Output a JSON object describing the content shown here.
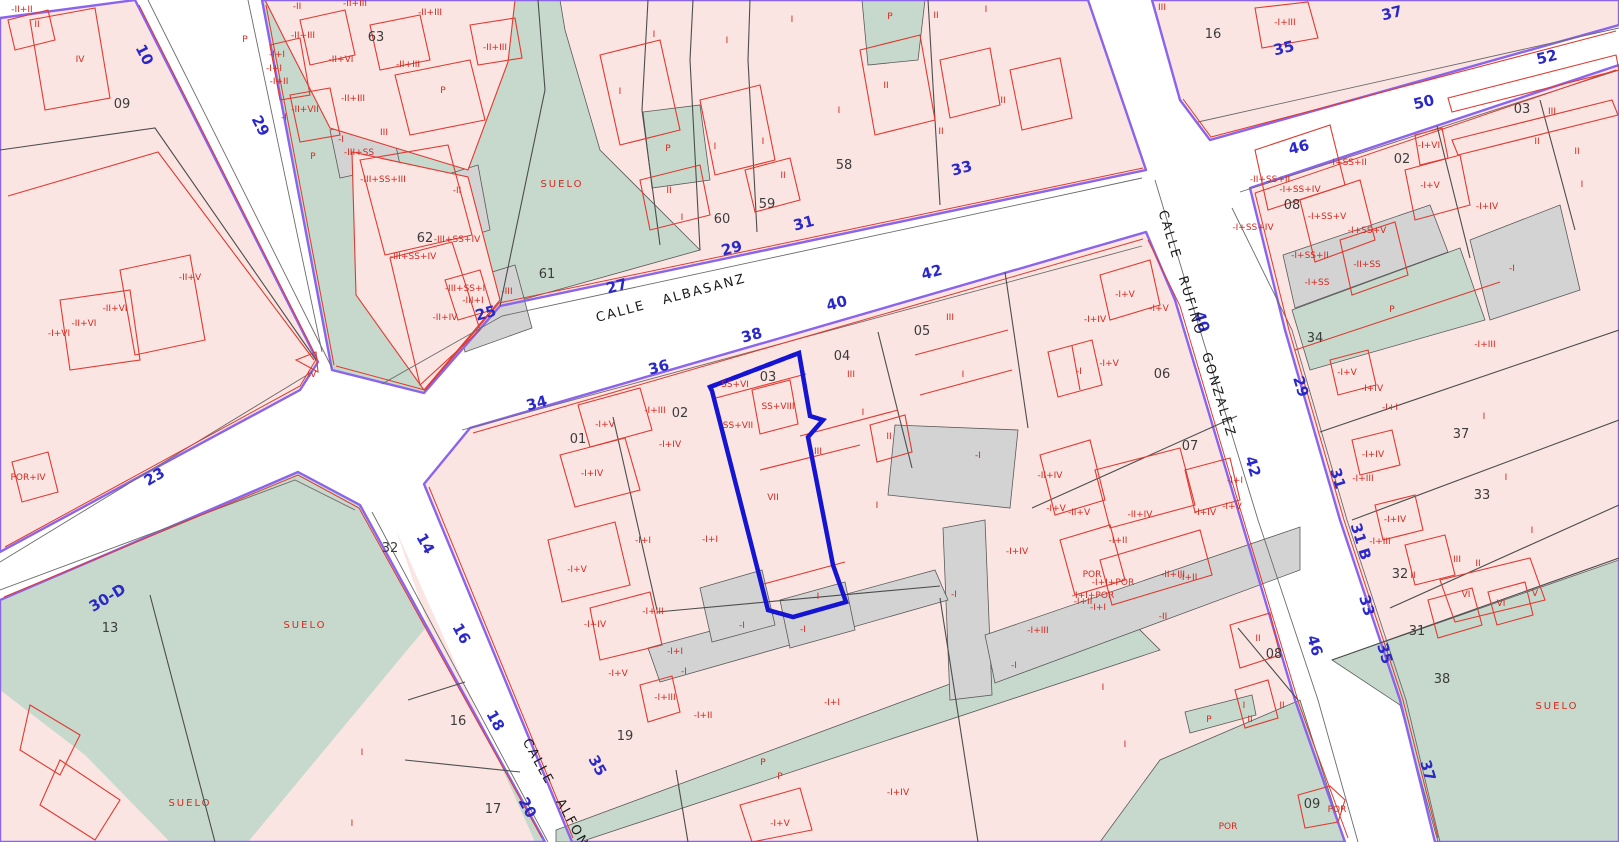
{
  "map": {
    "type": "cadastral-parcel-map",
    "selected_parcel": "03",
    "colors": {
      "parcel_pink": "#fbe5e3",
      "suelo_green": "#c7d9cc",
      "urban_gray": "#d3d3d3",
      "street_white": "#ffffff",
      "boundary_purple": "#8a64ec",
      "building_red": "#e03a30",
      "label_red": "#d6281e",
      "street_number_blue": "#2b28c8",
      "selected_blue": "#1414d2",
      "line_black": "#4d4d4d"
    },
    "street_names": [
      {
        "t": "CALLE ALBASANZ",
        "x": 672,
        "y": 302,
        "r": -15
      },
      {
        "t": "CALLE RUFINO GONZALEZ",
        "x": 1193,
        "y": 325,
        "r": 73
      },
      {
        "t": "CALLE ALFON",
        "x": 552,
        "y": 795,
        "r": 61
      }
    ],
    "street_numbers": [
      {
        "t": "10",
        "x": 140,
        "y": 57,
        "r": 63
      },
      {
        "t": "29",
        "x": 256,
        "y": 128,
        "r": 63
      },
      {
        "t": "23",
        "x": 157,
        "y": 481,
        "r": -31
      },
      {
        "t": "30-D",
        "x": 110,
        "y": 602,
        "r": -31
      },
      {
        "t": "25",
        "x": 487,
        "y": 318,
        "r": -15
      },
      {
        "t": "27",
        "x": 618,
        "y": 291,
        "r": -15
      },
      {
        "t": "29",
        "x": 733,
        "y": 253,
        "r": -15
      },
      {
        "t": "31",
        "x": 805,
        "y": 228,
        "r": -15
      },
      {
        "t": "33",
        "x": 963,
        "y": 173,
        "r": -15
      },
      {
        "t": "34",
        "x": 538,
        "y": 408,
        "r": -15
      },
      {
        "t": "36",
        "x": 660,
        "y": 372,
        "r": -15
      },
      {
        "t": "38",
        "x": 753,
        "y": 340,
        "r": -15
      },
      {
        "t": "40",
        "x": 838,
        "y": 308,
        "r": -15
      },
      {
        "t": "42",
        "x": 933,
        "y": 277,
        "r": -15
      },
      {
        "t": "35",
        "x": 1285,
        "y": 53,
        "r": -14
      },
      {
        "t": "37",
        "x": 1393,
        "y": 18,
        "r": -14
      },
      {
        "t": "46",
        "x": 1300,
        "y": 152,
        "r": -14
      },
      {
        "t": "50",
        "x": 1425,
        "y": 107,
        "r": -14
      },
      {
        "t": "52",
        "x": 1548,
        "y": 62,
        "r": -14
      },
      {
        "t": "40",
        "x": 1197,
        "y": 323,
        "r": 73
      },
      {
        "t": "42",
        "x": 1248,
        "y": 468,
        "r": 73
      },
      {
        "t": "29",
        "x": 1296,
        "y": 388,
        "r": 73
      },
      {
        "t": "31",
        "x": 1333,
        "y": 480,
        "r": 73
      },
      {
        "t": "31 B",
        "x": 1356,
        "y": 543,
        "r": 73
      },
      {
        "t": "33",
        "x": 1362,
        "y": 607,
        "r": 73
      },
      {
        "t": "35",
        "x": 1380,
        "y": 655,
        "r": 73
      },
      {
        "t": "37",
        "x": 1423,
        "y": 772,
        "r": 73
      },
      {
        "t": "46",
        "x": 1310,
        "y": 647,
        "r": 73
      },
      {
        "t": "14",
        "x": 421,
        "y": 546,
        "r": 61
      },
      {
        "t": "16",
        "x": 457,
        "y": 636,
        "r": 61
      },
      {
        "t": "18",
        "x": 491,
        "y": 723,
        "r": 61
      },
      {
        "t": "20",
        "x": 523,
        "y": 810,
        "r": 61
      },
      {
        "t": "35",
        "x": 593,
        "y": 768,
        "r": 61
      }
    ],
    "parcel_numbers": [
      {
        "t": "09",
        "x": 122,
        "y": 108
      },
      {
        "t": "63",
        "x": 376,
        "y": 41
      },
      {
        "t": "62",
        "x": 425,
        "y": 242
      },
      {
        "t": "61",
        "x": 547,
        "y": 278
      },
      {
        "t": "60",
        "x": 722,
        "y": 223
      },
      {
        "t": "59",
        "x": 767,
        "y": 208
      },
      {
        "t": "58",
        "x": 844,
        "y": 169
      },
      {
        "t": "16",
        "x": 1213,
        "y": 38
      },
      {
        "t": "08",
        "x": 1292,
        "y": 209
      },
      {
        "t": "02",
        "x": 1402,
        "y": 163
      },
      {
        "t": "03",
        "x": 1522,
        "y": 113
      },
      {
        "t": "34",
        "x": 1315,
        "y": 342
      },
      {
        "t": "37",
        "x": 1461,
        "y": 438
      },
      {
        "t": "33",
        "x": 1482,
        "y": 499
      },
      {
        "t": "32",
        "x": 1400,
        "y": 578
      },
      {
        "t": "31",
        "x": 1417,
        "y": 635
      },
      {
        "t": "38",
        "x": 1442,
        "y": 683
      },
      {
        "t": "13",
        "x": 110,
        "y": 632
      },
      {
        "t": "32",
        "x": 390,
        "y": 552
      },
      {
        "t": "16",
        "x": 458,
        "y": 725
      },
      {
        "t": "17",
        "x": 493,
        "y": 813
      },
      {
        "t": "01",
        "x": 578,
        "y": 443
      },
      {
        "t": "02",
        "x": 680,
        "y": 417
      },
      {
        "t": "03",
        "x": 768,
        "y": 381
      },
      {
        "t": "04",
        "x": 842,
        "y": 360
      },
      {
        "t": "05",
        "x": 922,
        "y": 335
      },
      {
        "t": "06",
        "x": 1162,
        "y": 378
      },
      {
        "t": "07",
        "x": 1190,
        "y": 450
      },
      {
        "t": "08",
        "x": 1274,
        "y": 658
      },
      {
        "t": "19",
        "x": 625,
        "y": 740
      },
      {
        "t": "09",
        "x": 1312,
        "y": 808
      }
    ],
    "building_labels": [
      {
        "t": "-II+II",
        "x": 22,
        "y": 12
      },
      {
        "t": "II",
        "x": 37,
        "y": 27
      },
      {
        "t": "IV",
        "x": 80,
        "y": 62
      },
      {
        "t": "-II+V",
        "x": 190,
        "y": 280
      },
      {
        "t": "-II+VI",
        "x": 115,
        "y": 311
      },
      {
        "t": "-II+VI",
        "x": 84,
        "y": 326
      },
      {
        "t": "-I+VI",
        "x": 59,
        "y": 336
      },
      {
        "t": "IV",
        "x": 312,
        "y": 377
      },
      {
        "t": "P",
        "x": 245,
        "y": 42
      },
      {
        "t": "-II",
        "x": 297,
        "y": 9
      },
      {
        "t": "-II+III",
        "x": 355,
        "y": 6
      },
      {
        "t": "-II+III",
        "x": 303,
        "y": 38
      },
      {
        "t": "-II+III",
        "x": 430,
        "y": 15
      },
      {
        "t": "-II+VI",
        "x": 341,
        "y": 62
      },
      {
        "t": "-II+III",
        "x": 408,
        "y": 67
      },
      {
        "t": "-II+III",
        "x": 495,
        "y": 50
      },
      {
        "t": "-I+I",
        "x": 277,
        "y": 57
      },
      {
        "t": "-I+I",
        "x": 274,
        "y": 71
      },
      {
        "t": "-I+II",
        "x": 279,
        "y": 84
      },
      {
        "t": "-II+VII",
        "x": 305,
        "y": 112
      },
      {
        "t": "-I",
        "x": 284,
        "y": 120
      },
      {
        "t": "-II+III",
        "x": 353,
        "y": 101
      },
      {
        "t": "P",
        "x": 443,
        "y": 93
      },
      {
        "t": "-I",
        "x": 341,
        "y": 142
      },
      {
        "t": "P",
        "x": 313,
        "y": 159
      },
      {
        "t": "-III+SS",
        "x": 359,
        "y": 155
      },
      {
        "t": "III",
        "x": 384,
        "y": 135
      },
      {
        "t": "-III+SS+III",
        "x": 383,
        "y": 182
      },
      {
        "t": "-II",
        "x": 457,
        "y": 193
      },
      {
        "t": "-III+SS+IV",
        "x": 457,
        "y": 242
      },
      {
        "t": "-III+SS+IV",
        "x": 413,
        "y": 259
      },
      {
        "t": "-III+SS+I",
        "x": 465,
        "y": 291
      },
      {
        "t": "-III+I",
        "x": 473,
        "y": 303
      },
      {
        "t": "-II+IV",
        "x": 445,
        "y": 320
      },
      {
        "t": "-III",
        "x": 507,
        "y": 294
      },
      {
        "t": "I",
        "x": 654,
        "y": 37
      },
      {
        "t": "I",
        "x": 620,
        "y": 94
      },
      {
        "t": "I",
        "x": 727,
        "y": 43
      },
      {
        "t": "P",
        "x": 668,
        "y": 151
      },
      {
        "t": "I",
        "x": 715,
        "y": 149
      },
      {
        "t": "I",
        "x": 763,
        "y": 144
      },
      {
        "t": "II",
        "x": 783,
        "y": 178
      },
      {
        "t": "II",
        "x": 669,
        "y": 193
      },
      {
        "t": "I",
        "x": 682,
        "y": 220
      },
      {
        "t": "I",
        "x": 792,
        "y": 22
      },
      {
        "t": "P",
        "x": 890,
        "y": 19
      },
      {
        "t": "II",
        "x": 936,
        "y": 18
      },
      {
        "t": "I",
        "x": 986,
        "y": 12
      },
      {
        "t": "II",
        "x": 886,
        "y": 88
      },
      {
        "t": "I",
        "x": 839,
        "y": 113
      },
      {
        "t": "II",
        "x": 941,
        "y": 134
      },
      {
        "t": "II",
        "x": 1003,
        "y": 103
      },
      {
        "t": "-I+V",
        "x": 1125,
        "y": 297
      },
      {
        "t": "SUELO",
        "x": 562,
        "y": 187,
        "cls": "suelo"
      },
      {
        "t": "-I+III",
        "x": 1285,
        "y": 25
      },
      {
        "t": "III",
        "x": 1162,
        "y": 10
      },
      {
        "t": "-II+SS+II",
        "x": 1270,
        "y": 182
      },
      {
        "t": "-I+SS+II",
        "x": 1348,
        "y": 165
      },
      {
        "t": "-I+SS+IV",
        "x": 1300,
        "y": 192
      },
      {
        "t": "-I+SS+V",
        "x": 1327,
        "y": 219
      },
      {
        "t": "-I+SS+V",
        "x": 1367,
        "y": 233
      },
      {
        "t": "-I+SS+IV",
        "x": 1253,
        "y": 230
      },
      {
        "t": "-I+SS+II",
        "x": 1310,
        "y": 258
      },
      {
        "t": "-I+SS",
        "x": 1317,
        "y": 285
      },
      {
        "t": "-II+SS",
        "x": 1367,
        "y": 267
      },
      {
        "t": "P",
        "x": 1392,
        "y": 312
      },
      {
        "t": "-I",
        "x": 1512,
        "y": 271
      },
      {
        "t": "-I+VI",
        "x": 1429,
        "y": 148
      },
      {
        "t": "-I+V",
        "x": 1430,
        "y": 188
      },
      {
        "t": "-I+IV",
        "x": 1487,
        "y": 209
      },
      {
        "t": "III",
        "x": 1552,
        "y": 114
      },
      {
        "t": "II",
        "x": 1537,
        "y": 144
      },
      {
        "t": "II",
        "x": 1577,
        "y": 154
      },
      {
        "t": "I",
        "x": 1582,
        "y": 187
      },
      {
        "t": "-I+III",
        "x": 1485,
        "y": 347
      },
      {
        "t": "-I+V",
        "x": 1347,
        "y": 375
      },
      {
        "t": "-I+IV",
        "x": 1372,
        "y": 391
      },
      {
        "t": "-I+I",
        "x": 1390,
        "y": 410
      },
      {
        "t": "I",
        "x": 1484,
        "y": 419
      },
      {
        "t": "-I+IV",
        "x": 1373,
        "y": 457
      },
      {
        "t": "-I+III",
        "x": 1363,
        "y": 481
      },
      {
        "t": "I",
        "x": 1506,
        "y": 480
      },
      {
        "t": "-I+IV",
        "x": 1395,
        "y": 522
      },
      {
        "t": "-I+III",
        "x": 1380,
        "y": 544
      },
      {
        "t": "I",
        "x": 1532,
        "y": 533
      },
      {
        "t": "III",
        "x": 1457,
        "y": 562
      },
      {
        "t": "II",
        "x": 1478,
        "y": 566
      },
      {
        "t": "II",
        "x": 1413,
        "y": 578
      },
      {
        "t": "VI",
        "x": 1466,
        "y": 597
      },
      {
        "t": "VI",
        "x": 1501,
        "y": 606
      },
      {
        "t": "V",
        "x": 1535,
        "y": 596
      },
      {
        "t": "SUELO",
        "x": 1557,
        "y": 709,
        "cls": "suelo"
      },
      {
        "t": "POR+IV",
        "x": 28,
        "y": 480
      },
      {
        "t": "I",
        "x": 362,
        "y": 755
      },
      {
        "t": "I",
        "x": 352,
        "y": 826
      },
      {
        "t": "SUELO",
        "x": 305,
        "y": 628,
        "cls": "suelo"
      },
      {
        "t": "SUELO",
        "x": 190,
        "y": 806,
        "cls": "suelo"
      },
      {
        "t": "-I+V",
        "x": 605,
        "y": 427
      },
      {
        "t": "-I+III",
        "x": 655,
        "y": 413
      },
      {
        "t": "-I+IV",
        "x": 670,
        "y": 447
      },
      {
        "t": "-I+IV",
        "x": 592,
        "y": 476
      },
      {
        "t": "-I+V",
        "x": 577,
        "y": 572
      },
      {
        "t": "-I+I",
        "x": 643,
        "y": 543
      },
      {
        "t": "-I+I",
        "x": 710,
        "y": 542
      },
      {
        "t": "-I+III",
        "x": 653,
        "y": 614
      },
      {
        "t": "-I+IV",
        "x": 595,
        "y": 627
      },
      {
        "t": "-I+V",
        "x": 618,
        "y": 676
      },
      {
        "t": "-I+I",
        "x": 675,
        "y": 654
      },
      {
        "t": "-I",
        "x": 742,
        "y": 628
      },
      {
        "t": "-I",
        "x": 684,
        "y": 674
      },
      {
        "t": "-I+III",
        "x": 665,
        "y": 700
      },
      {
        "t": "-I+II",
        "x": 703,
        "y": 718
      },
      {
        "t": "SS+VI",
        "x": 735,
        "y": 387
      },
      {
        "t": "SS+VIII",
        "x": 778,
        "y": 409
      },
      {
        "t": "SS+VII",
        "x": 738,
        "y": 428
      },
      {
        "t": "VII",
        "x": 773,
        "y": 500
      },
      {
        "t": "I",
        "x": 818,
        "y": 599
      },
      {
        "t": "-I",
        "x": 803,
        "y": 632
      },
      {
        "t": "III",
        "x": 851,
        "y": 377
      },
      {
        "t": "I",
        "x": 863,
        "y": 415
      },
      {
        "t": "II",
        "x": 889,
        "y": 439
      },
      {
        "t": "III",
        "x": 818,
        "y": 454
      },
      {
        "t": "I",
        "x": 877,
        "y": 508
      },
      {
        "t": "III",
        "x": 950,
        "y": 320
      },
      {
        "t": "I",
        "x": 963,
        "y": 377
      },
      {
        "t": "-I",
        "x": 978,
        "y": 458
      },
      {
        "t": "-I+IV",
        "x": 1095,
        "y": 322
      },
      {
        "t": "-I+V",
        "x": 1159,
        "y": 311
      },
      {
        "t": "-I",
        "x": 1079,
        "y": 374
      },
      {
        "t": "-I+V",
        "x": 1109,
        "y": 366
      },
      {
        "t": "-II+IV",
        "x": 1050,
        "y": 478
      },
      {
        "t": "-I+V",
        "x": 1056,
        "y": 511
      },
      {
        "t": "-II+V",
        "x": 1079,
        "y": 515
      },
      {
        "t": "-II+IV",
        "x": 1140,
        "y": 517
      },
      {
        "t": "-I+IV",
        "x": 1205,
        "y": 515
      },
      {
        "t": "-I+V",
        "x": 1232,
        "y": 509
      },
      {
        "t": "-I+I",
        "x": 1235,
        "y": 483
      },
      {
        "t": "-I+IV",
        "x": 1017,
        "y": 554
      },
      {
        "t": "-I+II",
        "x": 1118,
        "y": 543
      },
      {
        "t": "POR",
        "x": 1092,
        "y": 577
      },
      {
        "t": "-I+I+POR",
        "x": 1113,
        "y": 585
      },
      {
        "t": "-I+I+POR",
        "x": 1093,
        "y": 598
      },
      {
        "t": "-I+II",
        "x": 1083,
        "y": 604
      },
      {
        "t": "-II+III",
        "x": 1173,
        "y": 577
      },
      {
        "t": "-I+II",
        "x": 1188,
        "y": 580
      },
      {
        "t": "-I+I",
        "x": 1098,
        "y": 610
      },
      {
        "t": "-I+III",
        "x": 1038,
        "y": 633
      },
      {
        "t": "-II",
        "x": 1163,
        "y": 619
      },
      {
        "t": "-I",
        "x": 954,
        "y": 597
      },
      {
        "t": "-I",
        "x": 1014,
        "y": 668
      },
      {
        "t": "II",
        "x": 1258,
        "y": 641
      },
      {
        "t": "I",
        "x": 1103,
        "y": 690
      },
      {
        "t": "II",
        "x": 1282,
        "y": 708
      },
      {
        "t": "I",
        "x": 1244,
        "y": 708
      },
      {
        "t": "II",
        "x": 1250,
        "y": 722
      },
      {
        "t": "P",
        "x": 1209,
        "y": 722
      },
      {
        "t": "I",
        "x": 1125,
        "y": 747
      },
      {
        "t": "P",
        "x": 763,
        "y": 765
      },
      {
        "t": "P",
        "x": 780,
        "y": 779
      },
      {
        "t": "-I+IV",
        "x": 898,
        "y": 795
      },
      {
        "t": "-I+V",
        "x": 780,
        "y": 826
      },
      {
        "t": "-I+I",
        "x": 832,
        "y": 705
      },
      {
        "t": "POR",
        "x": 1228,
        "y": 829
      },
      {
        "t": "POR",
        "x": 1337,
        "y": 812
      }
    ]
  }
}
